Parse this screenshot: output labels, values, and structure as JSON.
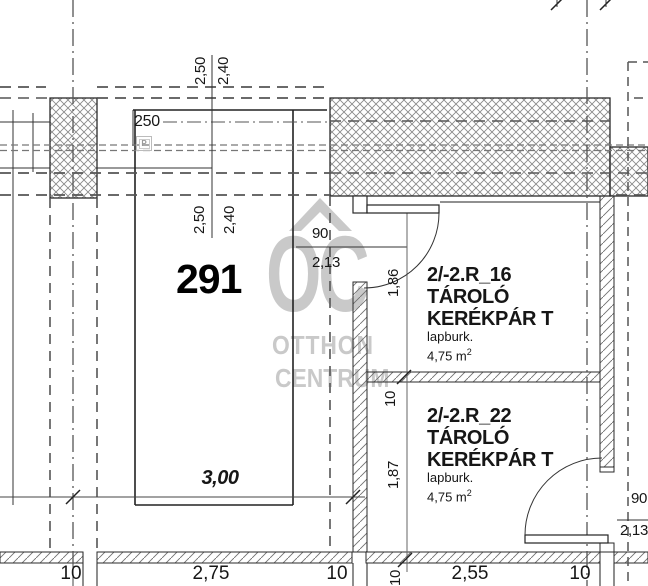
{
  "watermark": {
    "monogram": "OC",
    "name_line1": "OTTHON",
    "name_line2": "CENTRUM"
  },
  "labels": {
    "pier_width": "250",
    "room_number": "291",
    "room_width_m": "3,00",
    "parking_icon": "P",
    "dim_top": {
      "outer": "2,50",
      "inner": "2,40"
    },
    "dim_mid": {
      "outer": "2,50",
      "inner": "2,40"
    },
    "door_top": {
      "width_cm": "90",
      "height_m": "2,13"
    },
    "door_right": {
      "width_cm": "90",
      "height_m": "2,13"
    },
    "vertical_chain": {
      "room1_depth": "1,86",
      "wall": "10",
      "room2_depth": "1,87",
      "wall_bottom": "10"
    },
    "bottom_chain": [
      "10",
      "2,75",
      "10",
      "2,55",
      "10"
    ]
  },
  "rooms": [
    {
      "id": "2/-2.R_16",
      "type_line1": "TÁROLÓ",
      "type_line2": "KERÉKPÁR T",
      "finish": "lapburk.",
      "area": "4,75 m",
      "area_exp": "2"
    },
    {
      "id": "2/-2.R_22",
      "type_line1": "TÁROLÓ",
      "type_line2": "KERÉKPÁR T",
      "finish": "lapburk.",
      "area": "4,75 m",
      "area_exp": "2"
    }
  ],
  "colors": {
    "line": "#2a2a2a",
    "dash": "#555555",
    "crosshatch": "#8a8a8a",
    "hatch": "#6f6f6f",
    "watermark": "#c9c9c9"
  }
}
